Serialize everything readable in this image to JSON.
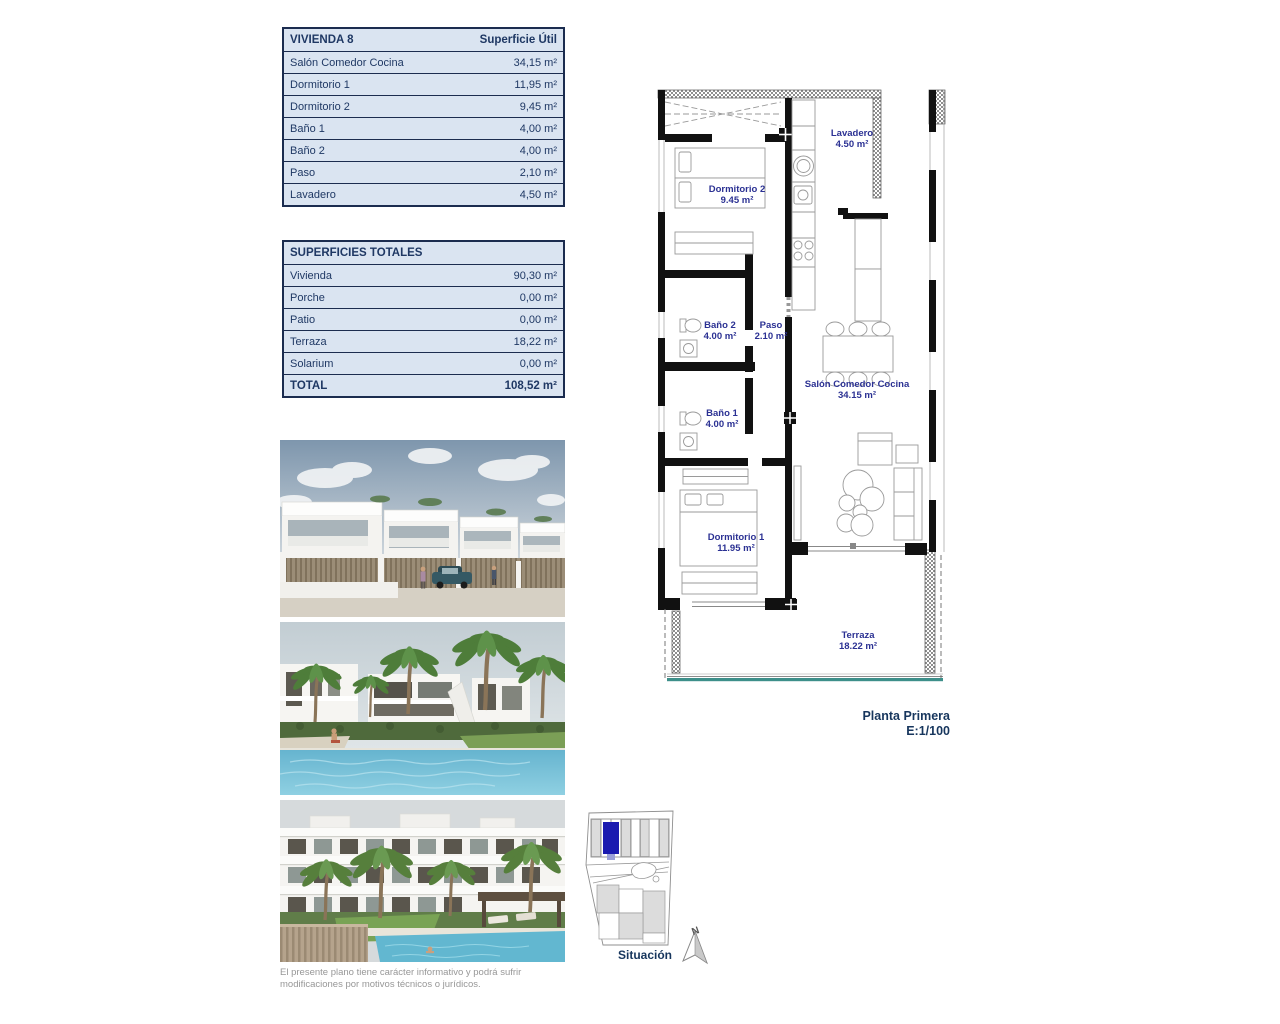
{
  "tables": {
    "vivienda": {
      "title": "VIVIENDA 8",
      "header_right": "Superficie Útil",
      "rows": [
        {
          "label": "Salón Comedor Cocina",
          "value": "34,15 m²"
        },
        {
          "label": "Dormitorio 1",
          "value": "11,95 m²"
        },
        {
          "label": "Dormitorio 2",
          "value": "9,45 m²"
        },
        {
          "label": "Baño 1",
          "value": "4,00 m²"
        },
        {
          "label": "Baño 2",
          "value": "4,00 m²"
        },
        {
          "label": "Paso",
          "value": "2,10 m²"
        },
        {
          "label": "Lavadero",
          "value": "4,50 m²"
        }
      ]
    },
    "totales": {
      "title": "SUPERFICIES TOTALES",
      "rows": [
        {
          "label": "Vivienda",
          "value": "90,30 m²"
        },
        {
          "label": "Porche",
          "value": "0,00 m²"
        },
        {
          "label": "Patio",
          "value": "0,00 m²"
        },
        {
          "label": "Terraza",
          "value": "18,22 m²"
        },
        {
          "label": "Solarium",
          "value": "0,00 m²"
        }
      ],
      "total": {
        "label": "TOTAL",
        "value": "108,52 m²"
      }
    }
  },
  "floor_plan": {
    "labels": {
      "lavadero": {
        "name": "Lavadero",
        "area": "4.50 m²"
      },
      "dormitorio2": {
        "name": "Dormitorio 2",
        "area": "9.45 m²"
      },
      "bano2": {
        "name": "Baño 2",
        "area": "4.00 m²"
      },
      "paso": {
        "name": "Paso",
        "area": "2.10 m²"
      },
      "salon": {
        "name": "Salón Comedor Cocina",
        "area": "34.15 m²"
      },
      "bano1": {
        "name": "Baño 1",
        "area": "4.00 m²"
      },
      "dormitorio1": {
        "name": "Dormitorio 1",
        "area": "11.95 m²"
      },
      "terraza": {
        "name": "Terraza",
        "area": "18.22 m²"
      }
    },
    "plan_title": "Planta Primera",
    "plan_scale": "E:1/100"
  },
  "situation": {
    "label": "Situación",
    "north": "N"
  },
  "disclaimer": {
    "line1": "El presente plano tiene carácter informativo y podrá sufrir",
    "line2": "modificaciones por motivos técnicos o jurídicos."
  },
  "colors": {
    "table_bg": "#dae4f1",
    "navy_text": "#1f3864",
    "plan_label": "#2b3193",
    "highlight_unit": "#1a1ab0",
    "terrace_edge_teal": "#3d8f8a"
  }
}
